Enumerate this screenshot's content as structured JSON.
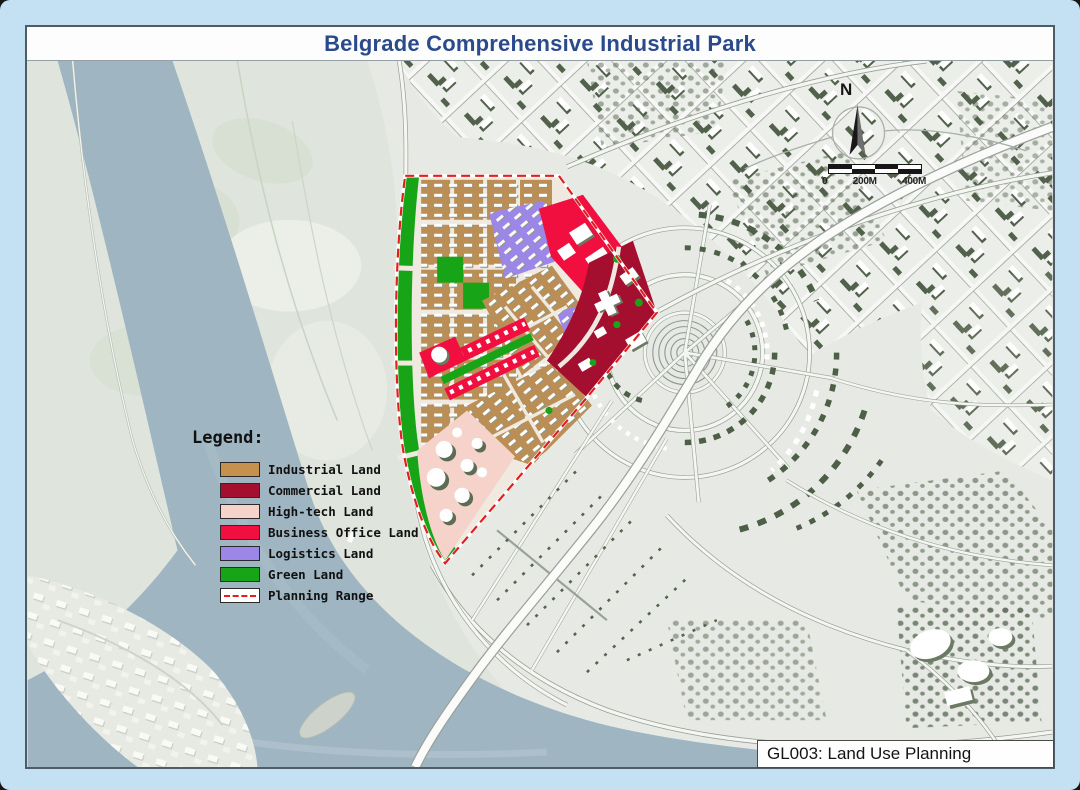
{
  "title": "Belgrade Comprehensive Industrial Park",
  "colors": {
    "title_text": "#2b4a8c",
    "planning_boundary": "#e02020",
    "frame_background": "#c3e1f3"
  },
  "legend": {
    "title": "Legend:",
    "items": [
      {
        "label": "Industrial Land",
        "color": "#c5914d"
      },
      {
        "label": "Commercial Land",
        "color": "#a50f2f"
      },
      {
        "label": "High-tech Land",
        "color": "#f5d3ca"
      },
      {
        "label": "Business Office Land",
        "color": "#f00f3f"
      },
      {
        "label": "Logistics Land",
        "color": "#9c87e8"
      },
      {
        "label": "Green Land",
        "color": "#17a517"
      },
      {
        "label": "Planning Range",
        "color": "#ffffff",
        "dash_color": "#e02020"
      }
    ]
  },
  "north": {
    "label": "N"
  },
  "scale_bar": {
    "labels": [
      "0",
      "200M",
      "400M"
    ]
  },
  "drawing_label": "GL003: Land Use Planning"
}
